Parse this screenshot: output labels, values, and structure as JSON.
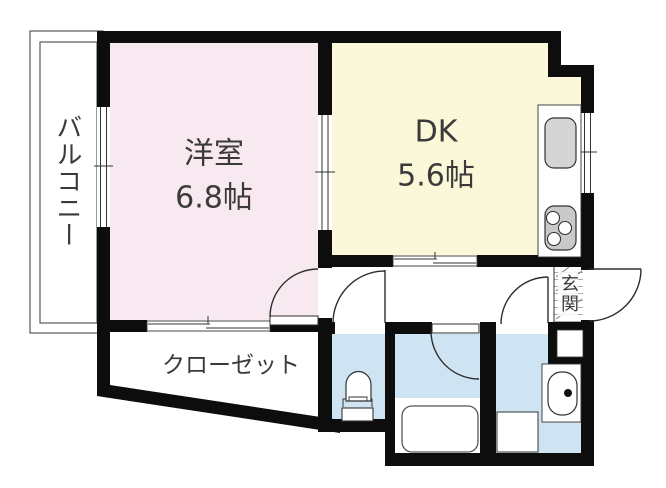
{
  "floorplan": {
    "balcony": {
      "label": "バルコニー"
    },
    "western_room": {
      "label": "洋室",
      "size": "6.8帖"
    },
    "dining_kitchen": {
      "label": "DK",
      "size": "5.6帖"
    },
    "closet": {
      "label": "クローゼット"
    },
    "entrance": {
      "label": "玄関"
    },
    "fixtures": {
      "kitchen_sink": "kitchen-sink",
      "stove": "stove-burners",
      "bathtub": "bathtub",
      "toilet": "toilet",
      "washbasin": "washbasin",
      "washing_machine_pan": "washing-machine-pan",
      "shoe_cabinet": "shoe-cabinet"
    },
    "colors": {
      "western_room_fill": "#f8e9f1",
      "dk_fill": "#fbf7d9",
      "wet_room_fill": "#cfe4f3",
      "wall": "#0d0d0d",
      "appliance_fill": "#d5d5d5",
      "label_text": "#3a3a3a"
    }
  }
}
